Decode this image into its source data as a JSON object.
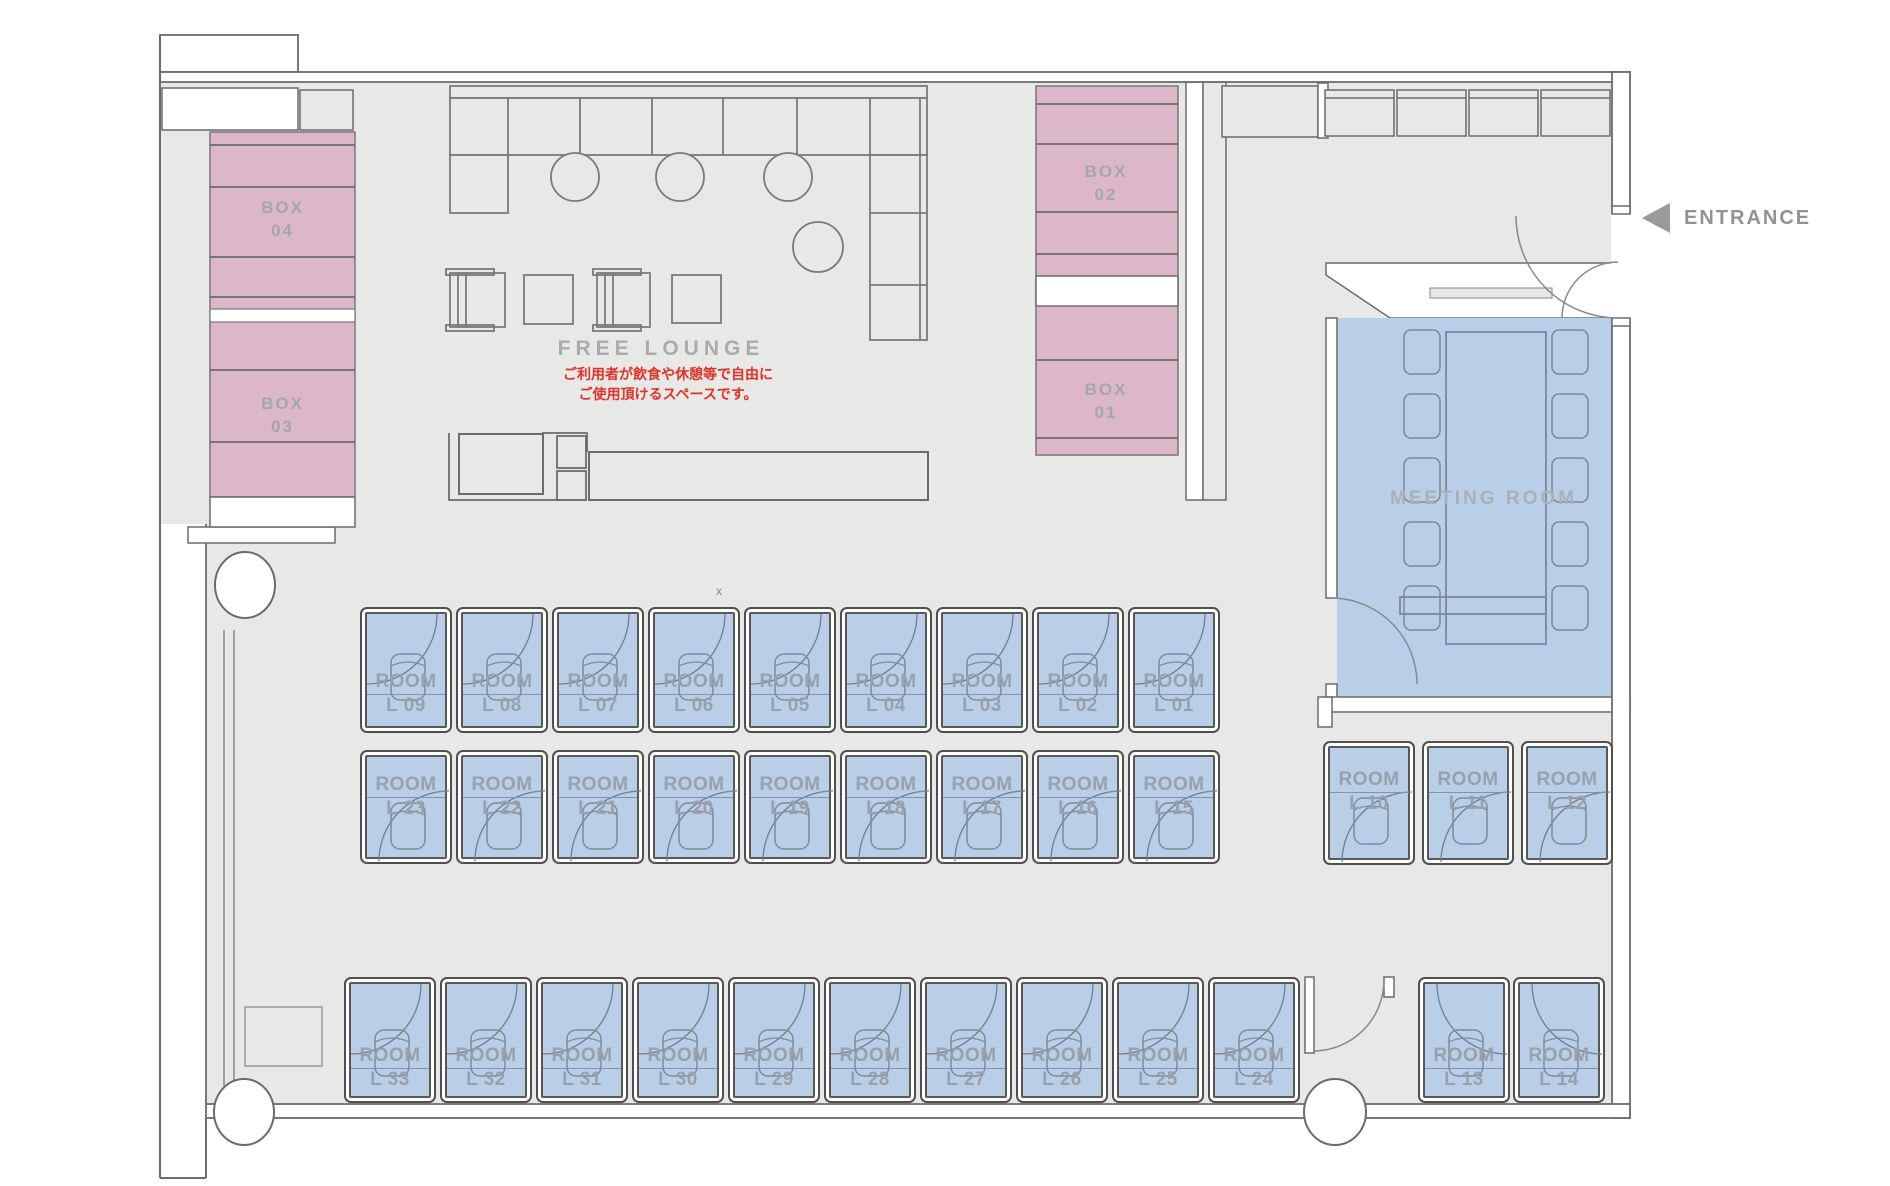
{
  "labels": {
    "free_lounge": "FREE LOUNGE",
    "free_lounge_note_line1": "ご利用者が飲食や休憩等で自由に",
    "free_lounge_note_line2": "ご使用頂けるスペースです。",
    "meeting_room": "MEETING ROOM",
    "entrance": "ENTRANCE",
    "room_prefix": "ROOM",
    "x_marker": "x"
  },
  "boxes": [
    {
      "id": "box-04",
      "label": "BOX",
      "number": "04"
    },
    {
      "id": "box-03",
      "label": "BOX",
      "number": "03"
    },
    {
      "id": "box-02",
      "label": "BOX",
      "number": "02"
    },
    {
      "id": "box-01",
      "label": "BOX",
      "number": "01"
    }
  ],
  "rooms": {
    "row_top": [
      "L 09",
      "L 08",
      "L 07",
      "L 06",
      "L 05",
      "L 04",
      "L 03",
      "L 02",
      "L 01"
    ],
    "row_mid": [
      "L 23",
      "L 22",
      "L 21",
      "L 20",
      "L 19",
      "L 18",
      "L 17",
      "L 16",
      "L 15"
    ],
    "row_bottom": [
      "L 33",
      "L 32",
      "L 31",
      "L 30",
      "L 29",
      "L 28",
      "L 27",
      "L 26",
      "L 25",
      "L 24"
    ],
    "right_col": [
      "L 10",
      "L 11",
      "L 12"
    ],
    "bottom_right": [
      "L 13",
      "L 14"
    ]
  },
  "colors": {
    "floor": "#e8e8e7",
    "wall": "#6b6b6b",
    "box_pink": "#dcb7c9",
    "room_blue": "#b9cfe8",
    "label_gray": "#98a1ab",
    "note_red": "#e23126",
    "furniture_line": "#7a7a7a"
  }
}
